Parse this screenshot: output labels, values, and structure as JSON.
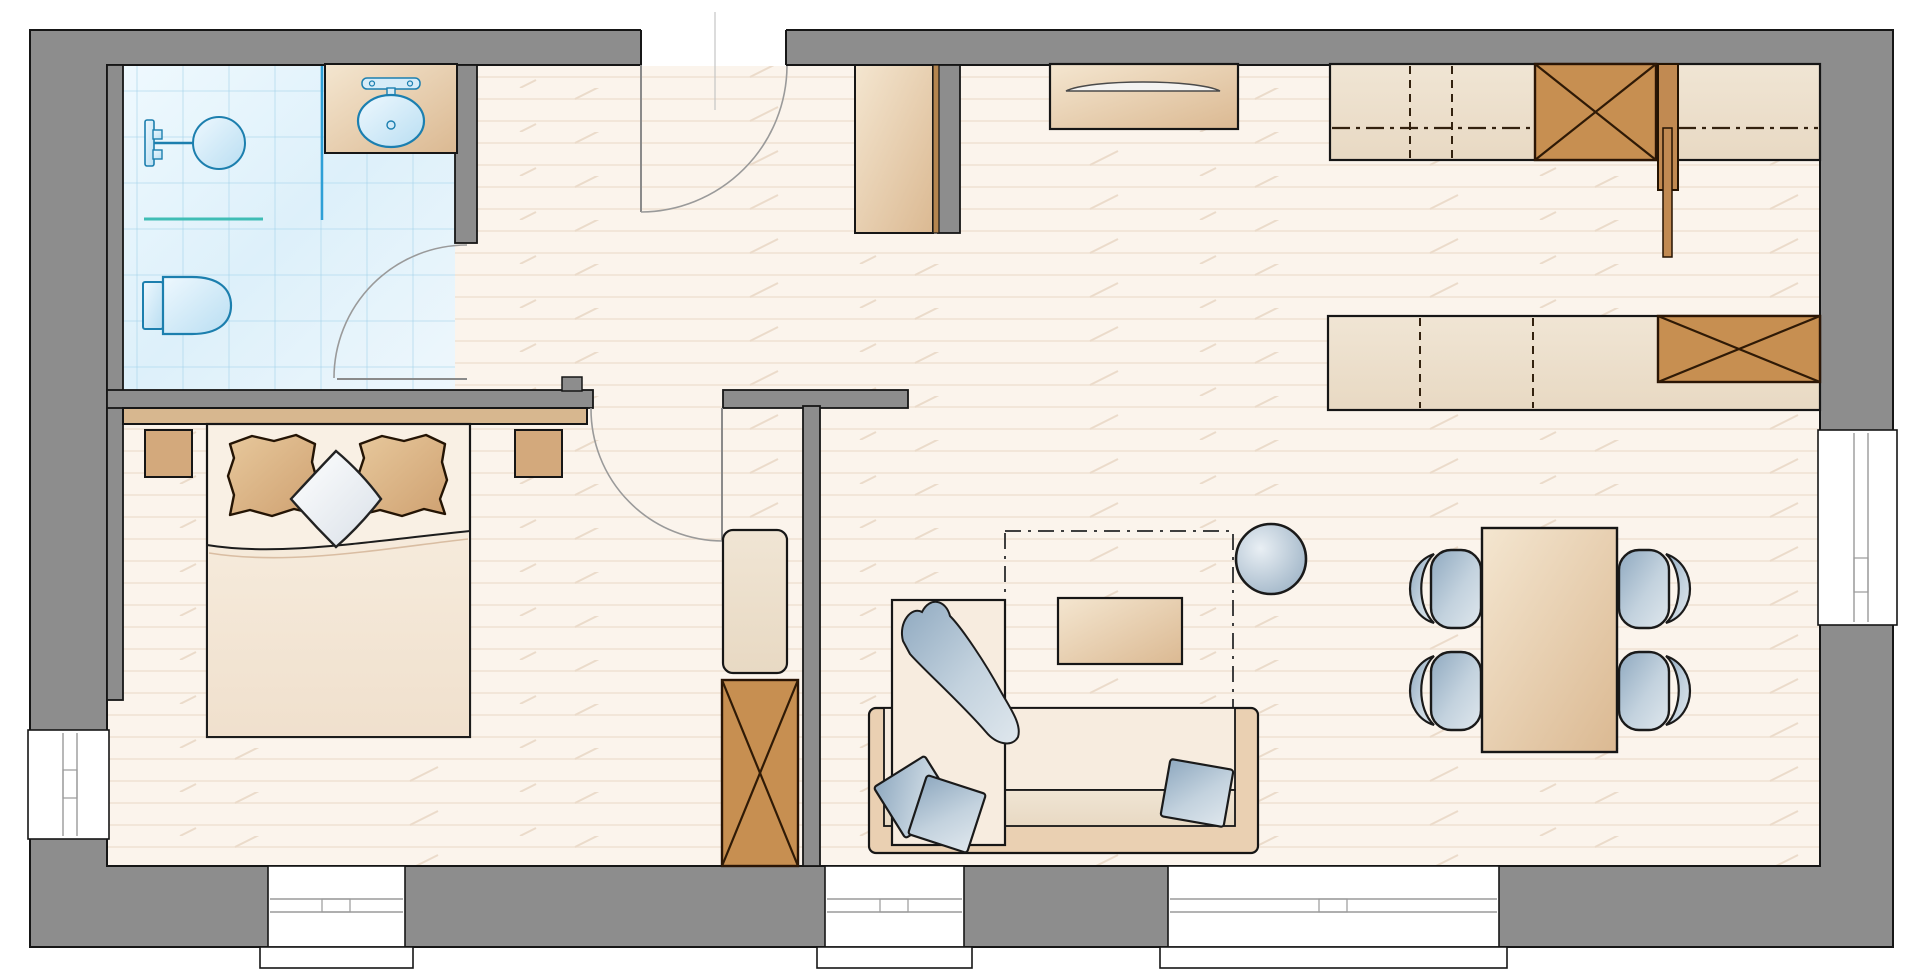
{
  "app": {
    "name": "apartment-floor-plan",
    "view": "top-down-2d"
  },
  "palette": {
    "wall_gray": "#8d8d8d",
    "outline_black": "#161616",
    "floor_cream": "#fbf4ec",
    "floor_plank_line": "#f0e2d3",
    "bath_tile_blue": "#d9eef9",
    "fixture_cyan": "#1c7fae",
    "glass_teal": "#3fbdb5",
    "furniture_tan": "#e6cda9",
    "cabinet_brown": "#c78f51",
    "textile_blue": "#a9bdcf",
    "bed_linen": "#f8efe2"
  },
  "rooms": [
    {
      "id": "bathroom",
      "features": [
        "shower-head",
        "glass-partition",
        "toilet",
        "washbasin-on-counter",
        "tiled-floor",
        "swing-door"
      ]
    },
    {
      "id": "bedroom",
      "features": [
        "double-bed",
        "headboard",
        "pillow-left",
        "pillow-right",
        "decorative-diamond-pillow",
        "blanket",
        "nightstand-left",
        "nightstand-right",
        "tall-cabinet",
        "wardrobe-x",
        "window-left",
        "window-bottom",
        "swing-door"
      ]
    },
    {
      "id": "hallway",
      "features": [
        "entrance-door",
        "wardrobe",
        "divider-wall"
      ]
    },
    {
      "id": "living-room",
      "features": [
        "sofa-with-chaise",
        "throw-blanket",
        "cushions-3",
        "coffee-table",
        "rug-dashed-outline",
        "pouf-ball",
        "window-bottom"
      ]
    },
    {
      "id": "dining-area",
      "features": [
        "dining-table",
        "chairs-4",
        "window-bottom-wide",
        "window-right"
      ]
    },
    {
      "id": "kitchen",
      "features": [
        "sideboard-curved-front",
        "counter-run-top",
        "counter-run-lower",
        "tall-unit-x-top",
        "tall-unit-x-lower",
        "panel-door"
      ]
    }
  ],
  "openings": {
    "entrance_doors": 1,
    "interior_doors": 2,
    "windows_bottom": 3,
    "windows_left": 1,
    "windows_right": 1
  }
}
